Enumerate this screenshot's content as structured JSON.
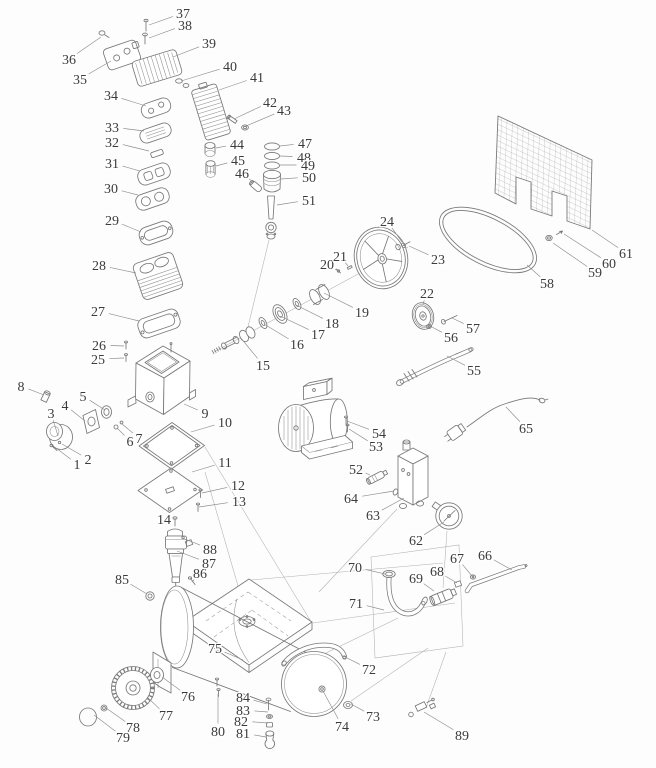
{
  "diagram": {
    "background": "#fdfdfd",
    "line_color": "#787878",
    "leader_color": "#8c8c8c",
    "label_color": "#3b3b3b",
    "label_font_size_px": 14,
    "callouts": [
      {
        "n": "1",
        "label_xy": [
          77,
          464
        ],
        "target_xy": [
          56,
          448
        ]
      },
      {
        "n": "2",
        "label_xy": [
          88,
          459
        ],
        "target_xy": [
          62,
          444
        ]
      },
      {
        "n": "3",
        "label_xy": [
          51,
          413
        ],
        "target_xy": [
          58,
          436
        ]
      },
      {
        "n": "4",
        "label_xy": [
          65,
          405
        ],
        "target_xy": [
          85,
          421
        ]
      },
      {
        "n": "5",
        "label_xy": [
          83,
          396
        ],
        "target_xy": [
          105,
          410
        ]
      },
      {
        "n": "6",
        "label_xy": [
          130,
          441
        ],
        "target_xy": [
          117,
          428
        ]
      },
      {
        "n": "7",
        "label_xy": [
          139,
          438
        ],
        "target_xy": [
          122,
          424
        ]
      },
      {
        "n": "8",
        "label_xy": [
          21,
          386
        ],
        "target_xy": [
          44,
          395
        ]
      },
      {
        "n": "9",
        "label_xy": [
          205,
          413
        ],
        "target_xy": [
          184,
          404
        ]
      },
      {
        "n": "10",
        "label_xy": [
          225,
          422
        ],
        "target_xy": [
          191,
          432
        ]
      },
      {
        "n": "11",
        "label_xy": [
          225,
          462
        ],
        "target_xy": [
          192,
          472
        ]
      },
      {
        "n": "12",
        "label_xy": [
          238,
          485
        ],
        "target_xy": [
          202,
          493
        ]
      },
      {
        "n": "13",
        "label_xy": [
          239,
          501
        ],
        "target_xy": [
          199,
          507
        ]
      },
      {
        "n": "14",
        "label_xy": [
          164,
          519
        ],
        "target_xy": [
          174,
          526
        ]
      },
      {
        "n": "15",
        "label_xy": [
          263,
          365
        ],
        "target_xy": [
          240,
          337
        ]
      },
      {
        "n": "16",
        "label_xy": [
          297,
          344
        ],
        "target_xy": [
          264,
          324
        ]
      },
      {
        "n": "17",
        "label_xy": [
          318,
          334
        ],
        "target_xy": [
          280,
          316
        ]
      },
      {
        "n": "18",
        "label_xy": [
          332,
          323
        ],
        "target_xy": [
          296,
          305
        ]
      },
      {
        "n": "19",
        "label_xy": [
          362,
          312
        ],
        "target_xy": [
          324,
          293
        ]
      },
      {
        "n": "20",
        "label_xy": [
          327,
          264
        ],
        "target_xy": [
          338,
          271
        ]
      },
      {
        "n": "21",
        "label_xy": [
          340,
          256
        ],
        "target_xy": [
          348,
          266
        ]
      },
      {
        "n": "22",
        "label_xy": [
          427,
          293
        ],
        "target_xy": [
          423,
          304
        ]
      },
      {
        "n": "23",
        "label_xy": [
          438,
          259
        ],
        "target_xy": [
          409,
          246
        ]
      },
      {
        "n": "24",
        "label_xy": [
          387,
          221
        ],
        "target_xy": [
          402,
          242
        ]
      },
      {
        "n": "25",
        "label_xy": [
          98,
          359
        ],
        "target_xy": [
          124,
          358
        ]
      },
      {
        "n": "26",
        "label_xy": [
          99,
          345
        ],
        "target_xy": [
          124,
          346
        ]
      },
      {
        "n": "27",
        "label_xy": [
          98,
          311
        ],
        "target_xy": [
          139,
          321
        ]
      },
      {
        "n": "28",
        "label_xy": [
          99,
          265
        ],
        "target_xy": [
          136,
          273
        ]
      },
      {
        "n": "29",
        "label_xy": [
          112,
          220
        ],
        "target_xy": [
          141,
          232
        ]
      },
      {
        "n": "30",
        "label_xy": [
          111,
          188
        ],
        "target_xy": [
          138,
          195
        ]
      },
      {
        "n": "31",
        "label_xy": [
          112,
          163
        ],
        "target_xy": [
          140,
          171
        ]
      },
      {
        "n": "32",
        "label_xy": [
          112,
          142
        ],
        "target_xy": [
          149,
          151
        ]
      },
      {
        "n": "33",
        "label_xy": [
          112,
          127
        ],
        "target_xy": [
          144,
          131
        ]
      },
      {
        "n": "34",
        "label_xy": [
          111,
          95
        ],
        "target_xy": [
          146,
          106
        ]
      },
      {
        "n": "35",
        "label_xy": [
          80,
          79
        ],
        "target_xy": [
          111,
          61
        ]
      },
      {
        "n": "36",
        "label_xy": [
          69,
          59
        ],
        "target_xy": [
          101,
          37
        ]
      },
      {
        "n": "37",
        "label_xy": [
          183,
          13
        ],
        "target_xy": [
          149,
          25
        ]
      },
      {
        "n": "38",
        "label_xy": [
          185,
          25
        ],
        "target_xy": [
          149,
          38
        ]
      },
      {
        "n": "39",
        "label_xy": [
          209,
          43
        ],
        "target_xy": [
          173,
          57
        ]
      },
      {
        "n": "40",
        "label_xy": [
          230,
          66
        ],
        "target_xy": [
          181,
          81
        ]
      },
      {
        "n": "41",
        "label_xy": [
          257,
          77
        ],
        "target_xy": [
          219,
          90
        ]
      },
      {
        "n": "42",
        "label_xy": [
          270,
          102
        ],
        "target_xy": [
          234,
          119
        ]
      },
      {
        "n": "43",
        "label_xy": [
          284,
          110
        ],
        "target_xy": [
          246,
          126
        ]
      },
      {
        "n": "44",
        "label_xy": [
          237,
          144
        ],
        "target_xy": [
          216,
          148
        ]
      },
      {
        "n": "45",
        "label_xy": [
          238,
          160
        ],
        "target_xy": [
          216,
          166
        ]
      },
      {
        "n": "46",
        "label_xy": [
          242,
          173
        ],
        "target_xy": [
          254,
          183
        ]
      },
      {
        "n": "47",
        "label_xy": [
          305,
          143
        ],
        "target_xy": [
          280,
          146
        ]
      },
      {
        "n": "48",
        "label_xy": [
          304,
          157
        ],
        "target_xy": [
          280,
          156
        ]
      },
      {
        "n": "49",
        "label_xy": [
          308,
          165
        ],
        "target_xy": [
          280,
          165
        ]
      },
      {
        "n": "50",
        "label_xy": [
          309,
          177
        ],
        "target_xy": [
          281,
          179
        ]
      },
      {
        "n": "51",
        "label_xy": [
          309,
          200
        ],
        "target_xy": [
          277,
          205
        ]
      },
      {
        "n": "52",
        "label_xy": [
          356,
          469
        ],
        "target_xy": [
          370,
          475
        ]
      },
      {
        "n": "53",
        "label_xy": [
          376,
          446
        ],
        "target_xy": [
          349,
          429
        ]
      },
      {
        "n": "54",
        "label_xy": [
          379,
          433
        ],
        "target_xy": [
          347,
          421
        ]
      },
      {
        "n": "55",
        "label_xy": [
          474,
          370
        ],
        "target_xy": [
          447,
          356
        ]
      },
      {
        "n": "56",
        "label_xy": [
          451,
          337
        ],
        "target_xy": [
          430,
          326
        ]
      },
      {
        "n": "57",
        "label_xy": [
          473,
          328
        ],
        "target_xy": [
          452,
          318
        ]
      },
      {
        "n": "58",
        "label_xy": [
          547,
          283
        ],
        "target_xy": [
          527,
          265
        ]
      },
      {
        "n": "59",
        "label_xy": [
          595,
          272
        ],
        "target_xy": [
          553,
          243
        ]
      },
      {
        "n": "60",
        "label_xy": [
          609,
          263
        ],
        "target_xy": [
          564,
          234
        ]
      },
      {
        "n": "61",
        "label_xy": [
          626,
          253
        ],
        "target_xy": [
          592,
          230
        ]
      },
      {
        "n": "62",
        "label_xy": [
          416,
          540
        ],
        "target_xy": [
          444,
          522
        ]
      },
      {
        "n": "63",
        "label_xy": [
          373,
          515
        ],
        "target_xy": [
          404,
          498
        ]
      },
      {
        "n": "64",
        "label_xy": [
          351,
          498
        ],
        "target_xy": [
          394,
          491
        ]
      },
      {
        "n": "65",
        "label_xy": [
          526,
          428
        ],
        "target_xy": [
          506,
          407
        ]
      },
      {
        "n": "66",
        "label_xy": [
          485,
          555
        ],
        "target_xy": [
          512,
          570
        ]
      },
      {
        "n": "67",
        "label_xy": [
          457,
          558
        ],
        "target_xy": [
          472,
          576
        ]
      },
      {
        "n": "68",
        "label_xy": [
          437,
          571
        ],
        "target_xy": [
          457,
          583
        ]
      },
      {
        "n": "69",
        "label_xy": [
          416,
          578
        ],
        "target_xy": [
          434,
          591
        ]
      },
      {
        "n": "70",
        "label_xy": [
          355,
          567
        ],
        "target_xy": [
          385,
          574
        ]
      },
      {
        "n": "71",
        "label_xy": [
          356,
          603
        ],
        "target_xy": [
          384,
          610
        ]
      },
      {
        "n": "72",
        "label_xy": [
          369,
          669
        ],
        "target_xy": [
          341,
          655
        ]
      },
      {
        "n": "73",
        "label_xy": [
          373,
          716
        ],
        "target_xy": [
          351,
          704
        ]
      },
      {
        "n": "74",
        "label_xy": [
          342,
          726
        ],
        "target_xy": [
          323,
          691
        ]
      },
      {
        "n": "75",
        "label_xy": [
          215,
          648
        ],
        "target_xy": [
          243,
          660
        ]
      },
      {
        "n": "76",
        "label_xy": [
          188,
          696
        ],
        "target_xy": [
          162,
          677
        ]
      },
      {
        "n": "77",
        "label_xy": [
          166,
          715
        ],
        "target_xy": [
          147,
          697
        ]
      },
      {
        "n": "78",
        "label_xy": [
          133,
          727
        ],
        "target_xy": [
          106,
          708
        ]
      },
      {
        "n": "79",
        "label_xy": [
          123,
          737
        ],
        "target_xy": [
          94,
          715
        ]
      },
      {
        "n": "80",
        "label_xy": [
          218,
          731
        ],
        "target_xy": [
          218,
          694
        ]
      },
      {
        "n": "81",
        "label_xy": [
          243,
          733
        ],
        "target_xy": [
          266,
          737
        ]
      },
      {
        "n": "82",
        "label_xy": [
          241,
          721
        ],
        "target_xy": [
          268,
          723
        ]
      },
      {
        "n": "83",
        "label_xy": [
          243,
          710
        ],
        "target_xy": [
          268,
          712
        ]
      },
      {
        "n": "84",
        "label_xy": [
          243,
          697
        ],
        "target_xy": [
          267,
          704
        ]
      },
      {
        "n": "85",
        "label_xy": [
          122,
          579
        ],
        "target_xy": [
          147,
          594
        ]
      },
      {
        "n": "86",
        "label_xy": [
          200,
          573
        ],
        "target_xy": [
          192,
          582
        ]
      },
      {
        "n": "87",
        "label_xy": [
          209,
          563
        ],
        "target_xy": [
          177,
          551
        ]
      },
      {
        "n": "88",
        "label_xy": [
          210,
          549
        ],
        "target_xy": [
          182,
          538
        ]
      },
      {
        "n": "89",
        "label_xy": [
          462,
          735
        ],
        "target_xy": [
          424,
          712
        ]
      }
    ]
  }
}
